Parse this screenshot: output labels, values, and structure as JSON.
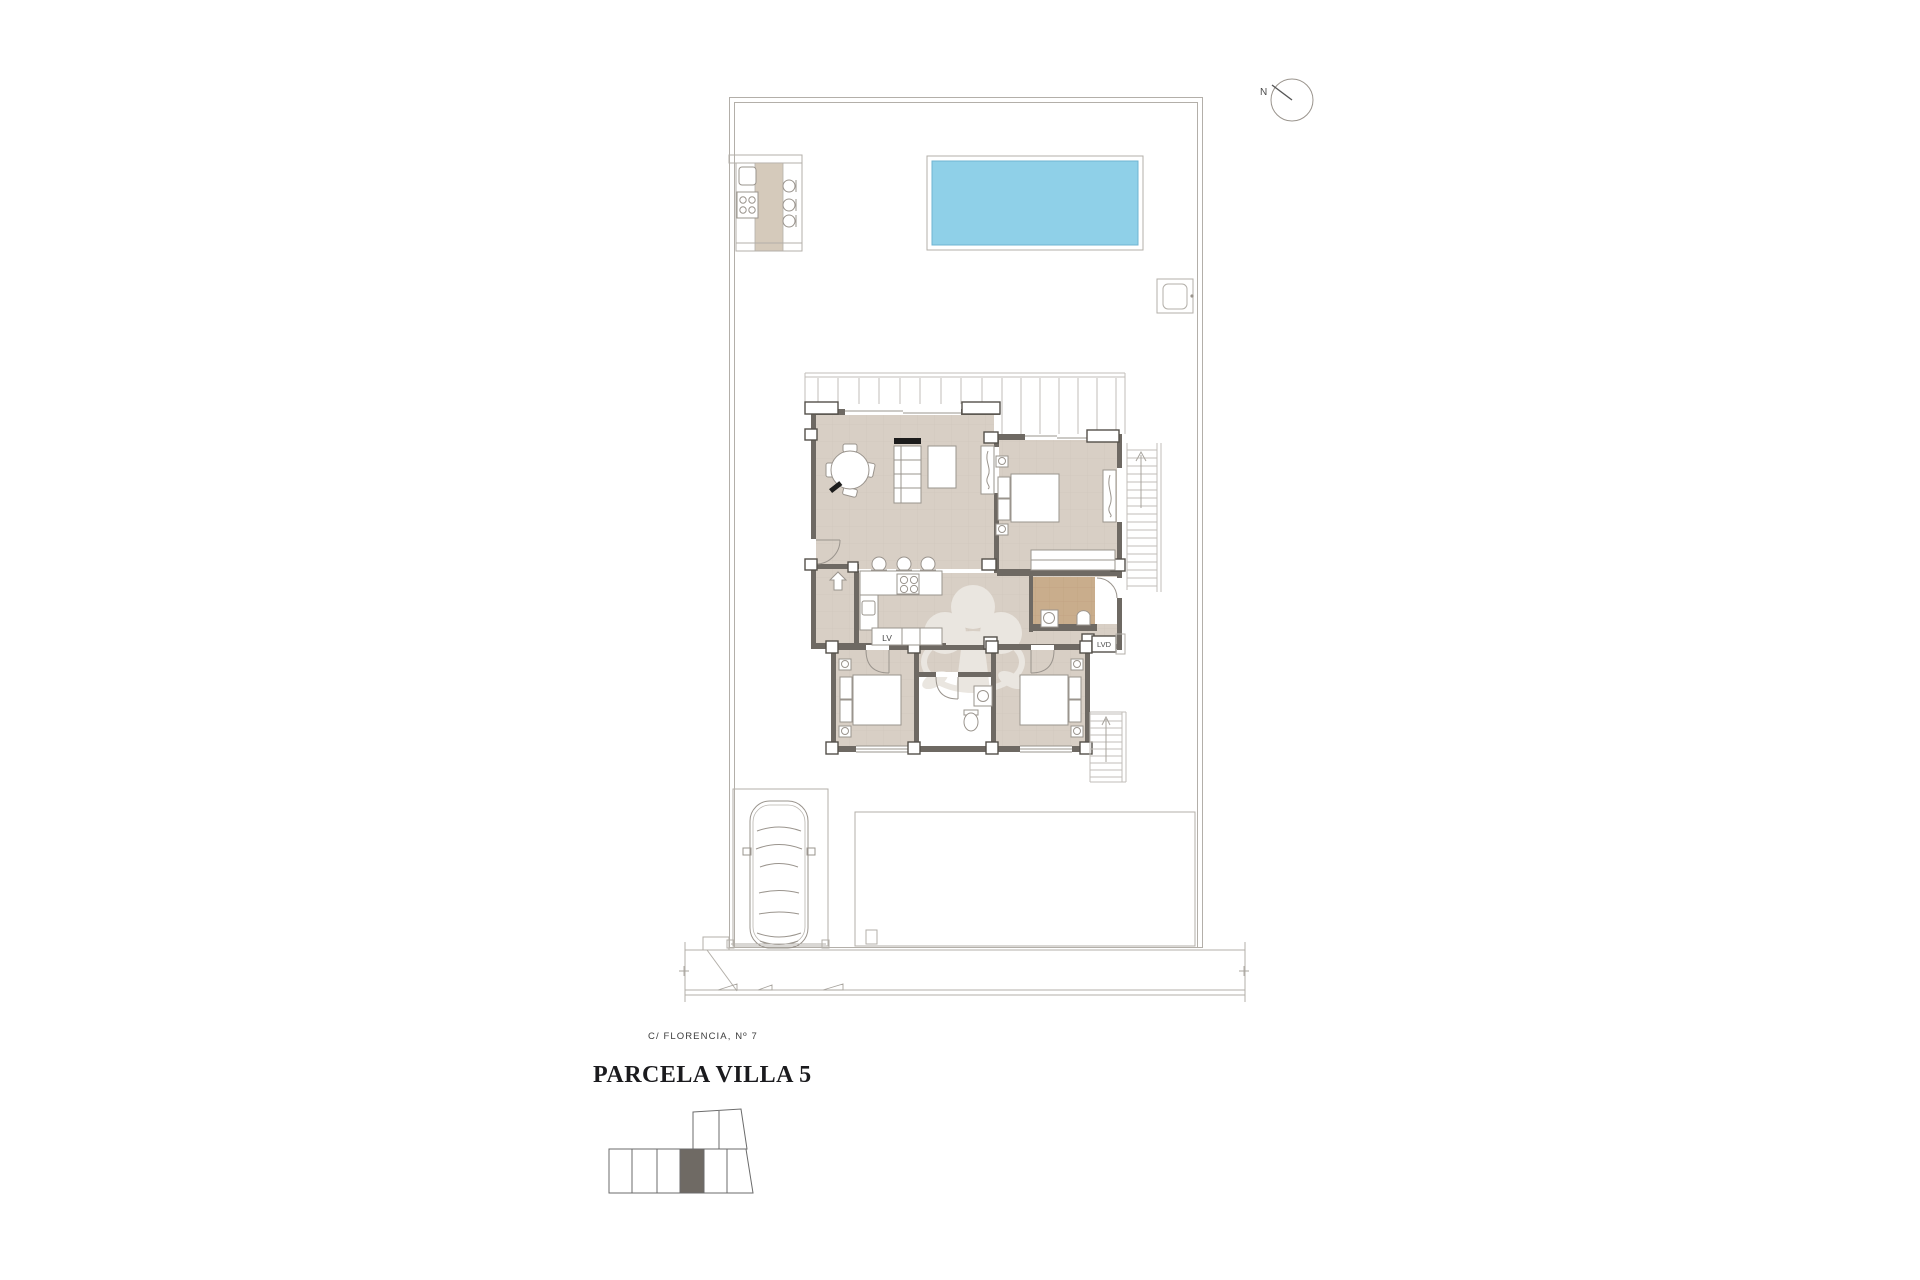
{
  "plan": {
    "title": "PARCELA VILLA 5",
    "street_label": "C/ FLORENCIA, Nº 7",
    "north_label": "N",
    "labels": {
      "dishwasher": "LV",
      "laundry": "LVD"
    },
    "colors": {
      "pool_water": "#8fd0e8",
      "floor_tan": "#d8cfc5",
      "bathroom_floor": "#c9ad8c",
      "wall": "#6e6963",
      "boundary_line": "#b3afa9",
      "counter_tan": "#d5cabb",
      "site_map_highlight": "#6f6a64"
    },
    "site_map": {
      "bottom_row_cells": 6,
      "top_row_cells": 2,
      "highlighted_cell": 4
    }
  }
}
